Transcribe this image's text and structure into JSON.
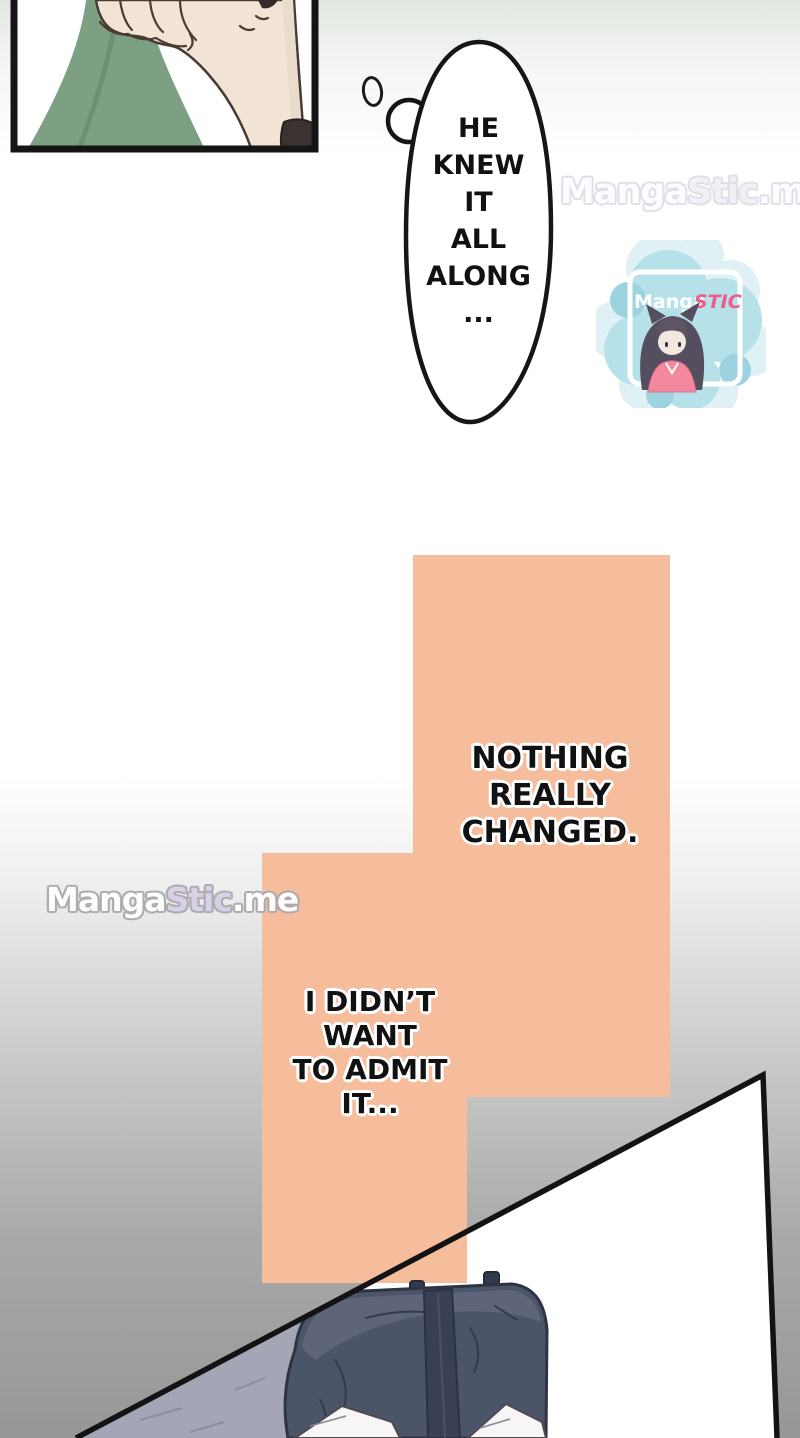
{
  "bubble": {
    "lines": [
      "HE",
      "KNEW",
      "IT",
      "ALL",
      "ALONG",
      "..."
    ]
  },
  "captions": {
    "nothing": {
      "lines": [
        "NOTHING",
        "REALLY",
        "CHANGED."
      ]
    },
    "admit": {
      "lines": [
        "I DIDN’T",
        "WANT",
        "TO ADMIT",
        "IT..."
      ]
    }
  },
  "watermarks": {
    "top_right": {
      "segments": [
        {
          "text": "Manga"
        },
        {
          "text": "Stic"
        },
        {
          "text": ".me"
        }
      ]
    },
    "mid_left": {
      "segments": [
        {
          "text": "Manga"
        },
        {
          "text": "Stic"
        },
        {
          "text": ".me"
        }
      ]
    }
  },
  "logo": {
    "brand_first": "Manga",
    "brand_second": "STIC"
  },
  "colors": {
    "caption_panel_orange": "#F6BD9C",
    "line_black": "#151515",
    "bubble_fill": "#FFFFFF",
    "sleeve_green": "#7DA083",
    "skin": "#F2E4D4",
    "logo_blob_teal": "#B7E1E9",
    "logo_pink": "#EE5C8C",
    "bag_body_navy": "#4C5468",
    "bag_pale": "#A4A6B6",
    "background_bottom_gray": "#979797"
  }
}
